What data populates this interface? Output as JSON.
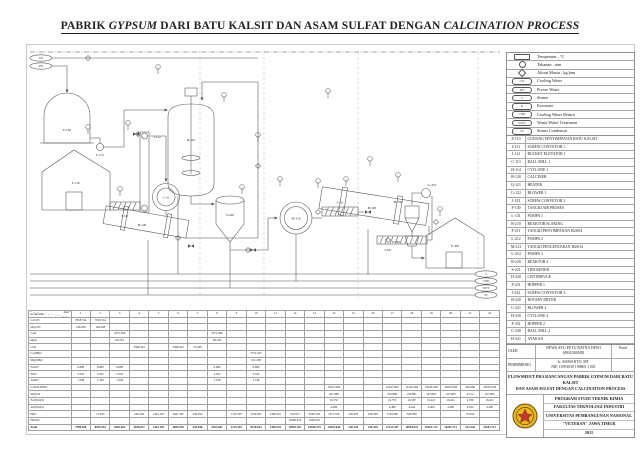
{
  "title": {
    "part1": "PABRIK ",
    "part2": "GYPSUM",
    "part3": " DARI BATU KALSIT DAN ASAM SULFAT DENGAN ",
    "part4": "CALCINATION PROCESS"
  },
  "legend": {
    "rows": [
      {
        "type": "temp",
        "text": "",
        "label": "Temperatur , °C"
      },
      {
        "type": "press",
        "text": "",
        "label": "Tekanan , atm"
      },
      {
        "type": "mass",
        "text": "",
        "label": "Aliran Massa , kg/jam"
      },
      {
        "type": "pill",
        "text": "CW",
        "label": "Cooling Water"
      },
      {
        "type": "pill",
        "text": "PW",
        "label": "Proses Water"
      },
      {
        "type": "pill",
        "text": "S",
        "label": "Steam"
      },
      {
        "type": "pill",
        "text": "K",
        "label": "Kerosene"
      },
      {
        "type": "pill",
        "text": "CWR",
        "label": "Cooling Water Return"
      },
      {
        "type": "pill",
        "text": "WWT",
        "label": "Waste Water Treatment"
      },
      {
        "type": "pill",
        "text": "SC",
        "label": "Steam Condensat"
      },
      {
        "type": "pill",
        "text": "CKR",
        "label": "Cooling Kerosene Return"
      }
    ]
  },
  "equipment_list": {
    "header": {
      "code": "KODE",
      "name": "NAMA ALAT"
    },
    "rows": [
      {
        "code": "F-110",
        "name": "GUDANG PENYIMPANAN BATU KALSIT"
      },
      {
        "code": "J-111",
        "name": "SCREW CONVEYOR 1"
      },
      {
        "code": "J-112",
        "name": "BUCKET ELEVATOR 1"
      },
      {
        "code": "C-113",
        "name": "BALL MILL 1"
      },
      {
        "code": "H-114",
        "name": "CYCLONE 1"
      },
      {
        "code": "B-120",
        "name": "CALCINER"
      },
      {
        "code": "Q-121",
        "name": "HEATER"
      },
      {
        "code": "G-122",
        "name": "BLOWER 1"
      },
      {
        "code": "J-123",
        "name": "SCREW CONVEYOR 2"
      },
      {
        "code": "F-130",
        "name": "TANGKI AIR PROSES"
      },
      {
        "code": "L-131",
        "name": "POMPA 1"
      },
      {
        "code": "R-210",
        "name": "REAKTOR SLAKING"
      },
      {
        "code": "F-211",
        "name": "TANGKI PENYIMPANAN H2SO4"
      },
      {
        "code": "L-212",
        "name": "POMPA 2"
      },
      {
        "code": "M-213",
        "name": "TANGKI PENGENCERAN H2SO4"
      },
      {
        "code": "L-214",
        "name": "POMPA 3"
      },
      {
        "code": "R-220",
        "name": "REAKTOR 2"
      },
      {
        "code": "S-221",
        "name": "THICKENER"
      },
      {
        "code": "H-230",
        "name": "CENTRIFUGE"
      },
      {
        "code": "F-231",
        "name": "HOPPER 1"
      },
      {
        "code": "J-232",
        "name": "SCREW CONVEYOR 3"
      },
      {
        "code": "B-320",
        "name": "ROTARY DRYER"
      },
      {
        "code": "G-321",
        "name": "BLOWER 2"
      },
      {
        "code": "H-330",
        "name": "CYCLONE 2"
      },
      {
        "code": "F-331",
        "name": "HOPPER 2"
      },
      {
        "code": "C-340",
        "name": "BALL MILL 2"
      },
      {
        "code": "H-341",
        "name": "AYAKAN"
      },
      {
        "code": "J-342",
        "name": "BUCKET ELEVATOR 2"
      },
      {
        "code": "J-343",
        "name": "SCREW CONVEYOR 4"
      },
      {
        "code": "F-350",
        "name": "GUDANG PENYIMPANAN GYPSUM"
      }
    ]
  },
  "title_block": {
    "oleh_label": "OLEH",
    "oleh_name": "DEWA AYU PUTU RATNA DEWI",
    "oleh_npm": "(0831010048)",
    "paraf_label": "Paraf",
    "pembimbing_label": "PEMBIMBING",
    "pembimbing_name": "Ir. SISWANTO, MT",
    "pembimbing_nip": "NIP. 19591030 198803 1 001",
    "caption_line1": "FLOWSHEET PRA RANCANGAN PABRIK GYPSUM DARI BATU KALSIT",
    "caption_line2": "DAN ASAM SULFAT DENGAN CALCINATION PROCESS",
    "institution": [
      "PROGRAM STUDI TEKNIK KIMIA",
      "FAKULTAS TEKNOLOGI INDUSTRI",
      "UNIVERSITAS PEMBANGUNAN NASIONAL",
      "\"VETERAN\" JAWA TIMUR",
      "2011"
    ]
  },
  "balance": {
    "corner_top": "Alur",
    "corner_bottom": "Komponen",
    "streams": [
      "1",
      "2",
      "3",
      "4",
      "5",
      "6",
      "7",
      "8",
      "9",
      "10",
      "11",
      "12",
      "13",
      "14",
      "15",
      "16",
      "17",
      "18",
      "19",
      "20",
      "21",
      "22"
    ],
    "rows": [
      {
        "name": "CaCO3",
        "values": {
          "1": "7818.744",
          "2": "7818.744"
        }
      },
      {
        "name": "MgCO3",
        "values": {
          "1": "146.208",
          "2": "146.208"
        }
      },
      {
        "name": "CaO",
        "values": {
          "3": "4372.496",
          "8": "4372.496"
        }
      },
      {
        "name": "MgO",
        "values": {
          "3": "69.794",
          "8": "69.794"
        }
      },
      {
        "name": "CO2",
        "values": {
          "4": "3398.343",
          "6": "3398.343",
          "7": "25.346"
        }
      },
      {
        "name": "Ca(OH)2",
        "values": {
          "10": "5772.347"
        }
      },
      {
        "name": "Mg(OH)2",
        "values": {
          "10": "101.238"
        }
      },
      {
        "name": "Fe2O3",
        "values": {
          "1": "6.689",
          "2": "6.689",
          "3": "6.689",
          "8": "6.689",
          "10": "6.689"
        }
      },
      {
        "name": "SiO2",
        "values": {
          "1": "3.345",
          "2": "3.345",
          "3": "3.345",
          "8": "3.345",
          "10": "3.345"
        }
      },
      {
        "name": "Al2O3",
        "values": {
          "1": "1.338",
          "2": "1.338",
          "3": "1.338",
          "8": "1.338",
          "10": "1.338"
        }
      },
      {
        "name": "CaSO4.2H2O",
        "values": {
          "14": "10247.963",
          "17": "10247.963",
          "18": "10145.483",
          "19": "10043.028",
          "20": "10043.028",
          "21": "464.460",
          "22": "10043.028"
        }
      },
      {
        "name": "MgSO4",
        "values": {
          "14": "201.880",
          "17": "201.880",
          "18": "199.861",
          "19": "197.863",
          "20": "197.863",
          "21": "9.152",
          "22": "197.863"
        }
      },
      {
        "name": "Fe2(SO4)3",
        "values": {
          "14": "16.755",
          "17": "16.755",
          "18": "16.587",
          "19": "16.421",
          "20": "16.421",
          "21": "0.760",
          "22": "16.421"
        }
      },
      {
        "name": "Al2(SO4)3",
        "values": {
          "14": "4.489",
          "17": "4.489",
          "18": "4.444",
          "19": "4.400",
          "20": "4.400",
          "21": "0.204",
          "22": "4.400"
        }
      },
      {
        "name": "H2O",
        "values": {
          "2": "21.945",
          "4": "240.294",
          "5": "1461.187",
          "6": "1461.187",
          "7": "240.294",
          "9": "1125.307",
          "10": "2534.697",
          "11": "1369.525",
          "12": "522.917",
          "13": "9500.250",
          "14": "2371.559",
          "15": "230.430",
          "16": "230.430",
          "17": "1743.260",
          "18": "628.298",
          "21": "37.950"
        }
      },
      {
        "name": "H2SO4",
        "values": {
          "12": "10460.250",
          "13": "1046.025"
        }
      },
      {
        "name": "Total",
        "total": true,
        "values": {
          "1": "7998.408",
          "2": "8020.353",
          "3": "4453.662",
          "4": "3638.637",
          "5": "1461.187",
          "6": "4859.530",
          "7": "265.640",
          "8": "4453.662",
          "9": "1125.307",
          "10": "8419.654",
          "11": "1369.525",
          "12": "10983.167",
          "13": "10546.275",
          "14": "12842.646",
          "15": "230.430",
          "16": "230.430",
          "17": "12213.347",
          "18": "10994.673",
          "19": "10261.712",
          "20": "10261.712",
          "21": "512.526",
          "22": "10261.712"
        }
      }
    ]
  },
  "diagram": {
    "equipment_labels": {
      "tank": "F-130",
      "pump": "L-131",
      "reactor": "R-210",
      "warehouse_in": "F-110",
      "screw1": "J-111",
      "elevator": "J-112",
      "ballmill": "C-113",
      "rotary1": "B-120",
      "thickener": "S-220",
      "centrifuge": "M-310",
      "screw2": "J-311",
      "rotary2": "B-320",
      "screw3": "J-321",
      "cyclone": "H-330",
      "blower": "G-331",
      "hopper": "F-340",
      "warehouse_out": "F-350"
    },
    "utility_in": [
      "CW",
      "PW"
    ],
    "utility_out": [
      "S",
      "CWR",
      "WWT",
      "SC"
    ]
  }
}
